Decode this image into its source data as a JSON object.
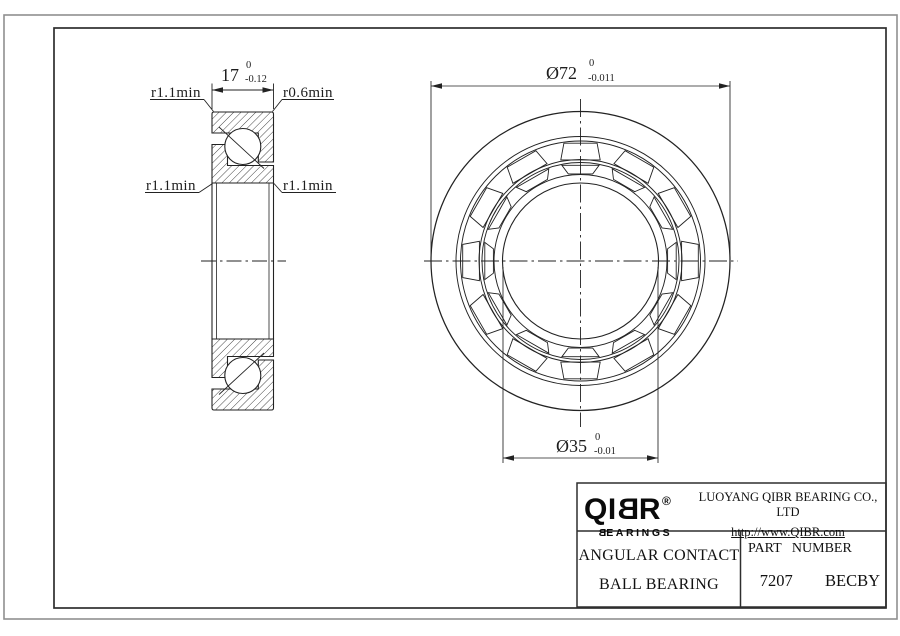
{
  "sheet": {
    "section_view": {
      "width_dim": {
        "nominal": "17",
        "tol_upper": "0",
        "tol_lower": "-0.12"
      },
      "radius_labels": {
        "top_left": "r1.1min",
        "top_right": "r0.6min",
        "bottom_left": "r1.1min",
        "bottom_right": "r1.1min"
      }
    },
    "front_view": {
      "od_dim": {
        "nominal": "Ø72",
        "tol_upper": "0",
        "tol_lower": "-0.011"
      },
      "bore_dim": {
        "nominal": "Ø35",
        "tol_upper": "0",
        "tol_lower": "-0.01"
      }
    }
  },
  "title_block": {
    "brand": {
      "part1": "QI",
      "part2_mirrored": "B",
      "part3": "R",
      "registered": "®",
      "sub_first_mirrored": "B",
      "sub_rest": "EARINGS"
    },
    "company": "LUOYANG QIBR BEARING CO., LTD",
    "website": "http://www.QIBR.com",
    "product_line1": "ANGULAR CONTACT",
    "product_line2": "BALL BEARING",
    "part_number_label": "PART NUMBER",
    "part_number": "7207  BECBY"
  },
  "colors": {
    "line": "#222222",
    "frame": "#2e2e2e",
    "outer_border": "#8f8f8f",
    "background": "#ffffff"
  }
}
